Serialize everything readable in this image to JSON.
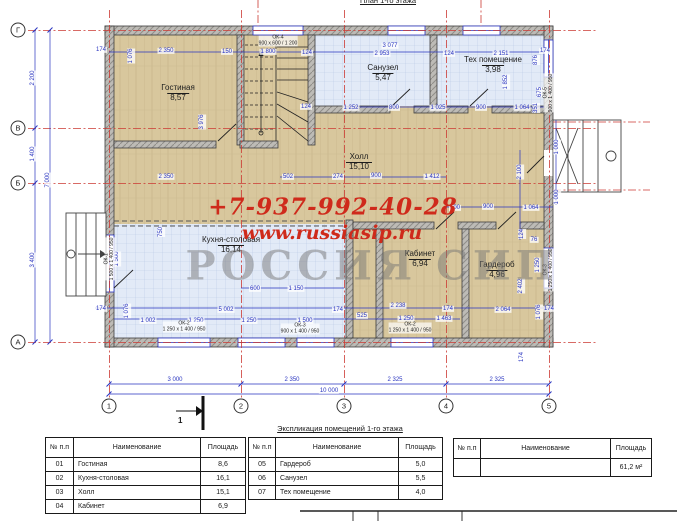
{
  "title": "План 1-го этажа",
  "watermark": {
    "phone": "+7-937-992-40-28",
    "site": "www.russiasip.ru",
    "brand": "РОССИЯ СИП"
  },
  "section_marker": {
    "label": "1"
  },
  "axes": {
    "rows": [
      {
        "label": "Г",
        "x": 18,
        "y": 30
      },
      {
        "label": "В",
        "x": 18,
        "y": 128
      },
      {
        "label": "Б",
        "x": 18,
        "y": 183
      },
      {
        "label": "А",
        "x": 18,
        "y": 342
      }
    ],
    "cols": [
      {
        "label": "1",
        "x": 109,
        "y": 406
      },
      {
        "label": "2",
        "x": 241,
        "y": 406
      },
      {
        "label": "3",
        "x": 344,
        "y": 406
      },
      {
        "label": "4",
        "x": 446,
        "y": 406
      },
      {
        "label": "5",
        "x": 549,
        "y": 406
      }
    ]
  },
  "rooms": [
    {
      "name": "Гостиная",
      "area": "8,57",
      "x": 178,
      "y": 84
    },
    {
      "name": "Санузел",
      "area": "5,47",
      "x": 383,
      "y": 64
    },
    {
      "name": "Тех помещение",
      "area": "3,98",
      "x": 493,
      "y": 56
    },
    {
      "name": "Холл",
      "area": "15,10",
      "x": 359,
      "y": 153
    },
    {
      "name": "Кухня-столовая",
      "area": "16,14",
      "x": 231,
      "y": 236
    },
    {
      "name": "Кабинет",
      "area": "6,94",
      "x": 420,
      "y": 250
    },
    {
      "name": "Гардероб",
      "area": "4,96",
      "x": 497,
      "y": 261
    }
  ],
  "dimensions": [
    {
      "t": "174",
      "x": 101,
      "y": 50
    },
    {
      "t": "1 076",
      "x": 131,
      "y": 56,
      "v": 1
    },
    {
      "t": "2 350",
      "x": 166,
      "y": 51
    },
    {
      "t": "150",
      "x": 227,
      "y": 52
    },
    {
      "t": "1 800",
      "x": 268,
      "y": 52
    },
    {
      "t": "124",
      "x": 307,
      "y": 53
    },
    {
      "t": "3 077",
      "x": 390,
      "y": 46
    },
    {
      "t": "2 953",
      "x": 382,
      "y": 54
    },
    {
      "t": "124",
      "x": 449,
      "y": 54
    },
    {
      "t": "2 151",
      "x": 501,
      "y": 54
    },
    {
      "t": "174",
      "x": 545,
      "y": 51
    },
    {
      "t": "876",
      "x": 536,
      "y": 60,
      "v": 1
    },
    {
      "t": "1 852",
      "x": 506,
      "y": 82,
      "v": 1
    },
    {
      "t": "675",
      "x": 540,
      "y": 92,
      "v": 1
    },
    {
      "t": "351",
      "x": 536,
      "y": 108,
      "v": 1
    },
    {
      "t": "1 252",
      "x": 351,
      "y": 108
    },
    {
      "t": "800",
      "x": 394,
      "y": 108
    },
    {
      "t": "1 025",
      "x": 438,
      "y": 108
    },
    {
      "t": "900",
      "x": 481,
      "y": 108
    },
    {
      "t": "1 064",
      "x": 522,
      "y": 108
    },
    {
      "t": "124",
      "x": 306,
      "y": 107
    },
    {
      "t": "3 976",
      "x": 202,
      "y": 122,
      "v": 1
    },
    {
      "t": "2 350",
      "x": 166,
      "y": 177
    },
    {
      "t": "502",
      "x": 288,
      "y": 177
    },
    {
      "t": "274",
      "x": 338,
      "y": 177
    },
    {
      "t": "900",
      "x": 376,
      "y": 176
    },
    {
      "t": "1 412",
      "x": 432,
      "y": 177
    },
    {
      "t": "2 100",
      "x": 520,
      "y": 172,
      "v": 1
    },
    {
      "t": "1 000",
      "x": 557,
      "y": 147,
      "v": 1
    },
    {
      "t": "1 000",
      "x": 557,
      "y": 197,
      "v": 1
    },
    {
      "t": "100",
      "x": 455,
      "y": 208
    },
    {
      "t": "900",
      "x": 488,
      "y": 207
    },
    {
      "t": "1 064",
      "x": 531,
      "y": 208
    },
    {
      "t": "124",
      "x": 522,
      "y": 234,
      "v": 1
    },
    {
      "t": "76",
      "x": 534,
      "y": 240
    },
    {
      "t": "1 250",
      "x": 538,
      "y": 265,
      "v": 1
    },
    {
      "t": "2 402",
      "x": 521,
      "y": 286,
      "v": 1
    },
    {
      "t": "750",
      "x": 161,
      "y": 232,
      "v": 1
    },
    {
      "t": "600",
      "x": 255,
      "y": 289
    },
    {
      "t": "1 150",
      "x": 296,
      "y": 289
    },
    {
      "t": "1 500",
      "x": 117,
      "y": 259,
      "v": 1
    },
    {
      "t": "174",
      "x": 101,
      "y": 309
    },
    {
      "t": "1 076",
      "x": 127,
      "y": 311,
      "v": 1
    },
    {
      "t": "5 002",
      "x": 226,
      "y": 310
    },
    {
      "t": "174",
      "x": 338,
      "y": 310
    },
    {
      "t": "525",
      "x": 362,
      "y": 316
    },
    {
      "t": "1 002",
      "x": 148,
      "y": 321
    },
    {
      "t": "1 250",
      "x": 196,
      "y": 321
    },
    {
      "t": "1 250",
      "x": 249,
      "y": 321
    },
    {
      "t": "1 500",
      "x": 305,
      "y": 321
    },
    {
      "t": "2 238",
      "x": 398,
      "y": 306
    },
    {
      "t": "174",
      "x": 448,
      "y": 309
    },
    {
      "t": "2 064",
      "x": 503,
      "y": 310
    },
    {
      "t": "1 076",
      "x": 539,
      "y": 312,
      "v": 1
    },
    {
      "t": "174",
      "x": 549,
      "y": 309
    },
    {
      "t": "1 250",
      "x": 406,
      "y": 319
    },
    {
      "t": "1 463",
      "x": 444,
      "y": 319
    },
    {
      "t": "174",
      "x": 522,
      "y": 357,
      "v": 1
    },
    {
      "t": "2 200",
      "x": 33,
      "y": 78,
      "v": 1
    },
    {
      "t": "1 400",
      "x": 33,
      "y": 154,
      "v": 1
    },
    {
      "t": "3 400",
      "x": 33,
      "y": 260,
      "v": 1
    },
    {
      "t": "7 000",
      "x": 48,
      "y": 180,
      "v": 1
    },
    {
      "t": "3 000",
      "x": 175,
      "y": 380
    },
    {
      "t": "2 350",
      "x": 292,
      "y": 380
    },
    {
      "t": "2 325",
      "x": 395,
      "y": 380
    },
    {
      "t": "2 325",
      "x": 497,
      "y": 380
    },
    {
      "t": "10 000",
      "x": 329,
      "y": 391
    }
  ],
  "window_tags": [
    {
      "t": "ОК-4",
      "s": "900 x 600 / 1 200",
      "x": 278,
      "y": 41
    },
    {
      "t": "ОК-2",
      "s": "1 250 x 1 400 / 950",
      "x": 184,
      "y": 327
    },
    {
      "t": "ОК-3",
      "s": "900 x 1 400 / 950",
      "x": 300,
      "y": 329
    },
    {
      "t": "ОК-2",
      "s": "1 250 x 1 400 / 950",
      "x": 410,
      "y": 328
    },
    {
      "t": "ОК-1",
      "s": "1 500 x 1 400 / 950",
      "x": 110,
      "y": 259,
      "v": 1
    },
    {
      "t": "ОК-5",
      "s": "900 x 1 400 / 950",
      "x": 549,
      "y": 93,
      "v": 1
    },
    {
      "t": "ОК-3",
      "s": "1 250 x 1 400 / 950",
      "x": 549,
      "y": 270,
      "v": 1
    }
  ],
  "explication": {
    "caption": "Экспликация помещений 1-го этажа",
    "headers": [
      "№ п.п",
      "Наименование",
      "Площадь"
    ],
    "left_rows": [
      [
        "01",
        "Гостиная",
        "8,6"
      ],
      [
        "02",
        "Кухня-столовая",
        "16,1"
      ],
      [
        "03",
        "Холл",
        "15,1"
      ],
      [
        "04",
        "Кабинет",
        "6,9"
      ]
    ],
    "right_rows": [
      [
        "05",
        "Гардероб",
        "5,0"
      ],
      [
        "06",
        "Санузел",
        "5,5"
      ],
      [
        "07",
        "Тех помещение",
        "4,0"
      ]
    ],
    "total_rows": [
      [
        "",
        "",
        "61,2 м²"
      ]
    ]
  },
  "colors": {
    "dimension_blue": "#2a35c0",
    "axis_red": "#cc3a33",
    "watermark_red": "#cf2a1b",
    "brand_gray": "#9a9a9a",
    "wood_floor": "#d8c79d",
    "tile_floor": "#e2eaf7",
    "wall_gray": "#bdbbb6"
  }
}
